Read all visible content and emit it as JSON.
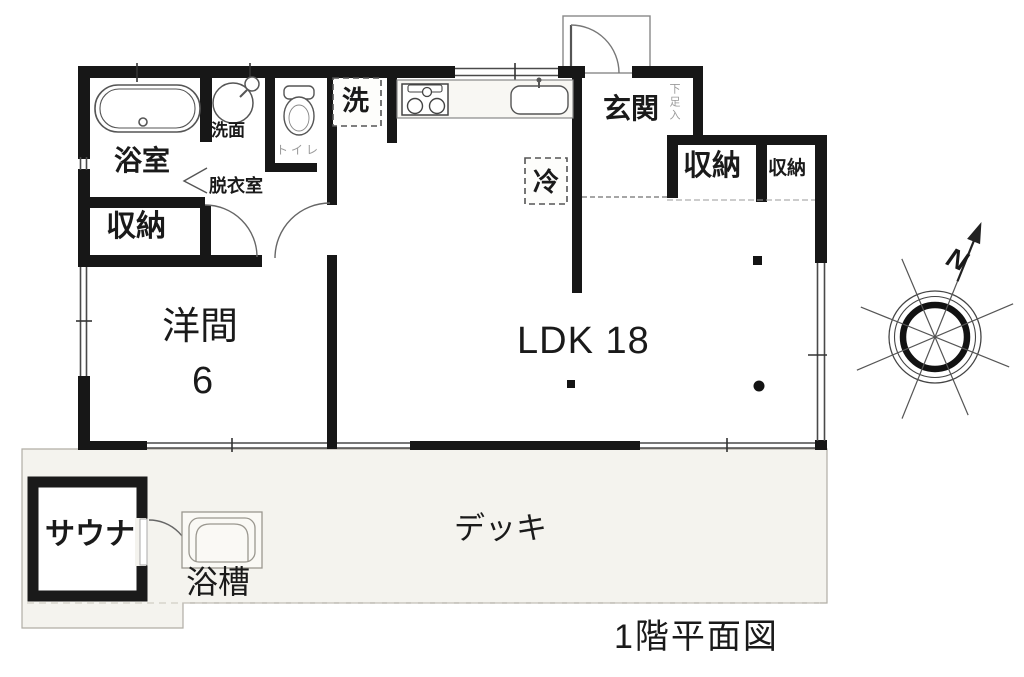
{
  "title": {
    "caption": "1階平面図"
  },
  "compass": {
    "label": "N"
  },
  "rooms": {
    "bathroom": {
      "label": "浴室"
    },
    "washstand": {
      "label": "洗面"
    },
    "dressing_room": {
      "label": "脱衣室"
    },
    "toilet": {
      "label": "トイレ"
    },
    "storage_left": {
      "label": "収納"
    },
    "storage_right_large": {
      "label": "収納"
    },
    "storage_right_small": {
      "label": "収納"
    },
    "entrance": {
      "label": "玄関"
    },
    "shoe_cabinet": {
      "label": "下足入"
    },
    "washer": {
      "label": "洗"
    },
    "fridge": {
      "label": "冷"
    },
    "western_room": {
      "label": "洋間",
      "size": "6"
    },
    "ldk": {
      "label": "LDK 18"
    },
    "sauna": {
      "label": "サウナ"
    },
    "outdoor_bathtub": {
      "label": "浴槽"
    },
    "deck": {
      "label": "デッキ"
    }
  },
  "colors": {
    "wall": "#171717",
    "deck_fill": "#f4f3ee",
    "line": "#555555",
    "text": "#1a1a1a",
    "muted_text": "#9a9a9a"
  }
}
